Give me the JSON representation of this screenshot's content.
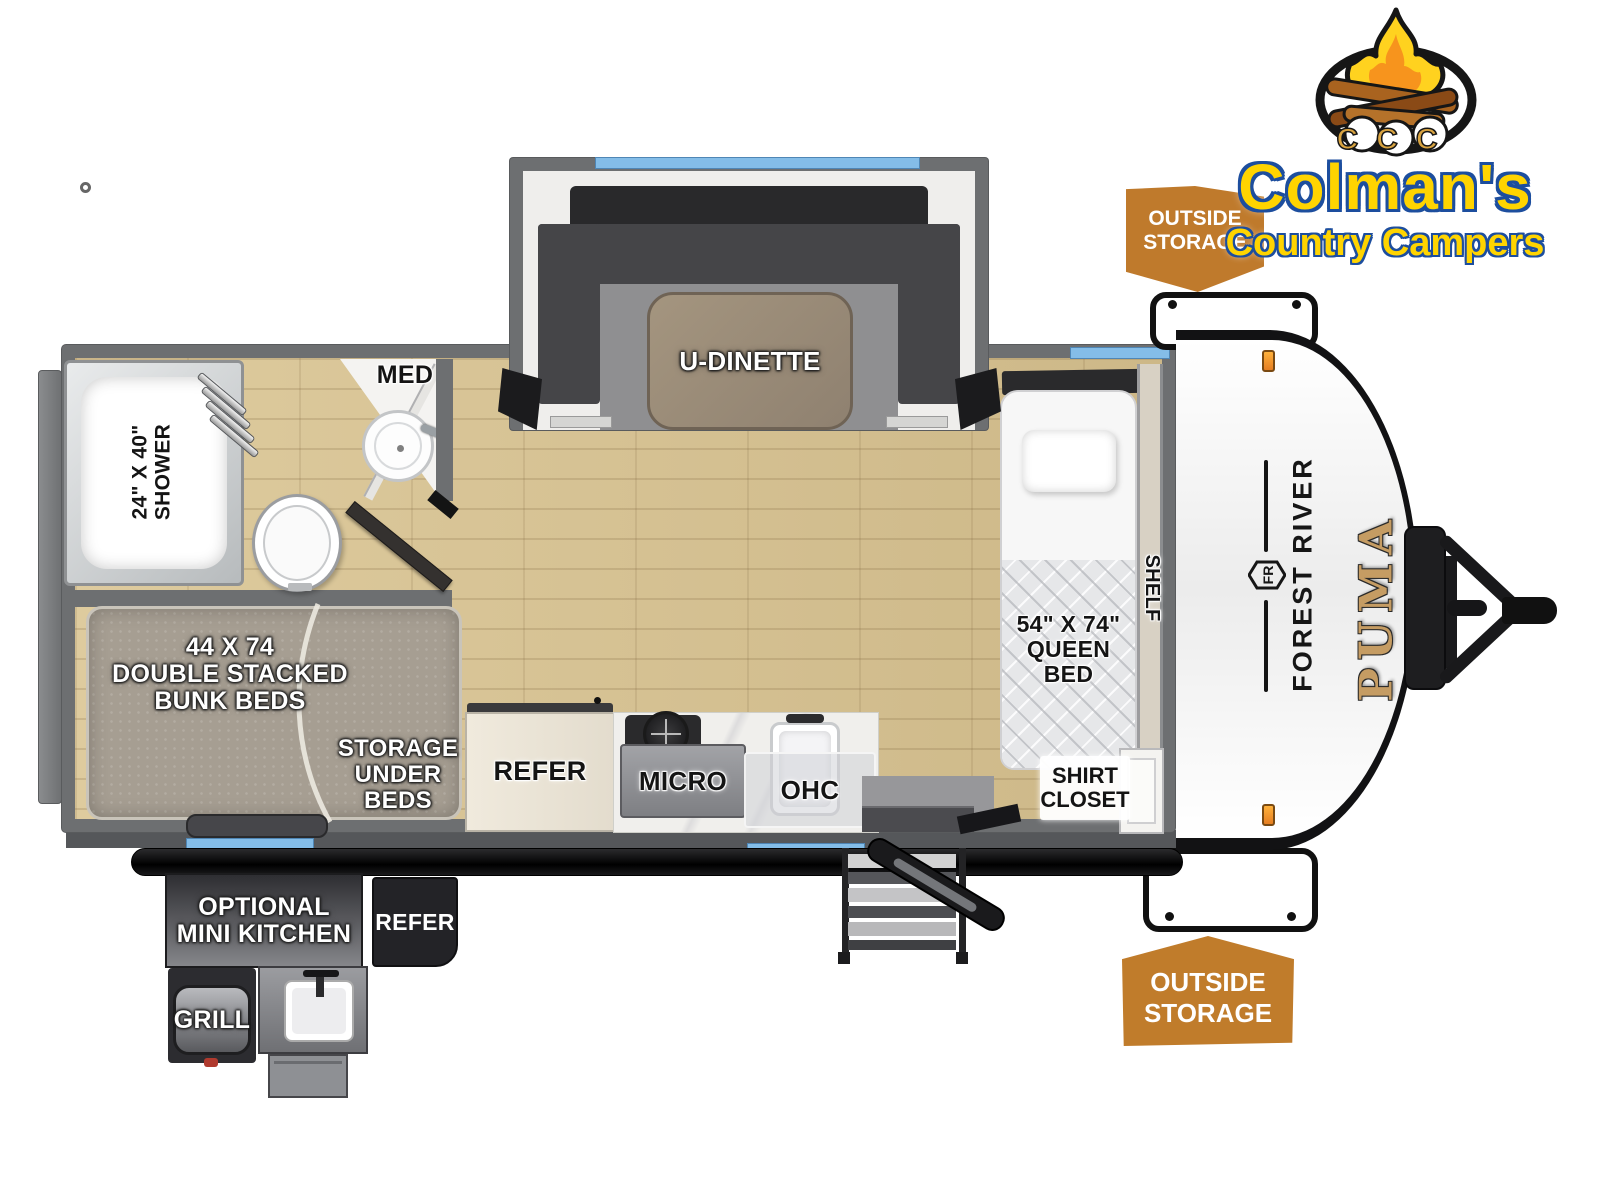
{
  "dealer": {
    "name": "Colman's",
    "tagline": "Country Campers",
    "monogram": "CCC"
  },
  "manufacturer": {
    "make": "FOREST RIVER",
    "emblem": "FR",
    "model": "PUMA"
  },
  "badges": {
    "top": {
      "line1": "OUTSIDE",
      "line2": "STORAGE"
    },
    "bottom": {
      "line1": "OUTSIDE",
      "line2": "STORAGE"
    }
  },
  "interior": {
    "dinette": {
      "label": "U-DINETTE"
    },
    "bathroom": {
      "med": "MED",
      "shower_size": "24\" X 40\"",
      "shower": "SHOWER"
    },
    "bunk": {
      "size": "44 X 74",
      "line2": "DOUBLE STACKED",
      "line3": "BUNK BEDS",
      "storage1": "STORAGE",
      "storage2": "UNDER",
      "storage3": "BEDS"
    },
    "kitchen": {
      "refer": "REFER",
      "micro": "MICRO",
      "ohc": "OHC"
    },
    "bedroom": {
      "bed_size": "54\" X 74\"",
      "bed_line2": "QUEEN",
      "bed_line3": "BED",
      "shelf": "SHELF",
      "closet1": "SHIRT",
      "closet2": "CLOSET"
    }
  },
  "exterior": {
    "mini_kitchen1": "OPTIONAL",
    "mini_kitchen2": "MINI KITCHEN",
    "refer": "REFER",
    "grill": "GRILL"
  },
  "colors": {
    "badge_orange": "#c0792b",
    "window_blue": "#84bde8",
    "wall_gray": "#6d6f71",
    "logo_yellow": "#ffd400",
    "logo_blue": "#1d4e9e",
    "puma_gold": "#c59c63"
  }
}
